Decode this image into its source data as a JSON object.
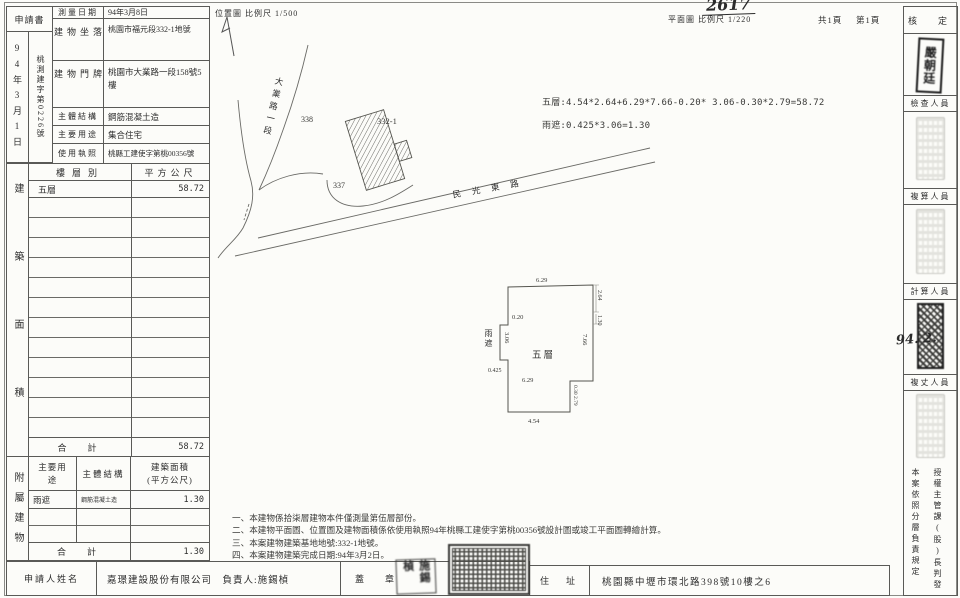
{
  "header": {
    "doc_no_handwritten": "2617",
    "site_map_label": "位置圖  比例尺 1/500",
    "plan_label": "平面圖  比例尺 1/220",
    "pages_total": "共1頁",
    "page_current": "第1頁"
  },
  "receipt": {
    "doc_label": "申請書",
    "date": "94年3月1日",
    "file_no": "桃測建字第0226號"
  },
  "building": {
    "survey_date_label": "測量日期",
    "survey_date": "94年3月8日",
    "site_label": "建物坐落",
    "site_value": "桃園市福元段332-1地號",
    "door_label": "建物門牌",
    "door_value": "桃園市大業路一段158號5樓",
    "structure_label": "主體結構",
    "structure_value": "鋼筋混凝土造",
    "use_label": "主要用途",
    "use_value": "集合住宅",
    "license_label": "使用執照",
    "license_value": "桃縣工建使字第桃00356號"
  },
  "floor_area": {
    "side_label": "建築面積",
    "col_floor": "樓層別",
    "col_sqm": "平方公尺",
    "floor_1": "五層",
    "area_1": "58.72",
    "total_label": "合　計",
    "total": "58.72"
  },
  "annex": {
    "side_label": "附屬建物",
    "col_use": "主要用途",
    "col_structure": "主體結構",
    "col_area_1": "建築面積",
    "col_area_2": "(平方公尺)",
    "use_1": "雨遮",
    "structure_1": "鋼筋混凝土造",
    "area_1": "1.30",
    "total_label": "合　計",
    "total": "1.30"
  },
  "applicant": {
    "name_label": "申請人姓名",
    "name_value": "嘉璟建設股份有限公司　負責人:施錫楨",
    "seal_label": "蓋　章",
    "person_seal": "施錫楨",
    "addr_label": "住　址",
    "addr_value": "桃園縣中壢市環北路398號10樓之6"
  },
  "site_plan": {
    "road_main": "大業路一段",
    "road_east": "民光東路",
    "parcel_338": "338",
    "parcel_332_1": "332-1",
    "parcel_337": "337"
  },
  "formula": {
    "line_floor": "五層:4.54*2.64+6.29*7.66-0.20* 3.06-0.30*2.79=58.72",
    "line_canopy": "雨遮:0.425*3.06=1.30"
  },
  "floor_plan": {
    "room_label": "五層",
    "canopy_label": "雨遮",
    "dim_top": "6.29",
    "dim_bottom": "4.54",
    "dim_right": "7.66",
    "dim_right_top": "2.64",
    "dim_right_top2": "1.30",
    "dim_left": "3.06",
    "dim_left_small": "0.20",
    "dim_canopy": "0.425",
    "dim_notch_w": "0.30",
    "dim_notch_h": "2.79",
    "dim_inner": "6.29"
  },
  "notes": {
    "n1": "一、本建物係拾柒層建物本件僅測量第伍層部份。",
    "n2": "二、本建物平面圖、位置圖及建物面積係依使用執照94年桃縣工建使字第桃00356號設計圖或竣工平面圖轉繪計算。",
    "n3": "三、本案建物建築基地地號:332-1地號。",
    "n4": "四、本案建物建築完成日期:94年3月2日。"
  },
  "approval": {
    "approve_label": "核　定",
    "approver_stamp": "嚴朝廷",
    "check_label": "檢查人員",
    "recalc_label": "複算人員",
    "calc_label": "計算人員",
    "resurvey_label": "複丈人員",
    "handwritten": "94. 2.",
    "delegation_left": "本案依照分層負責規定",
    "delegation_right": "授權主管課(股)長判發"
  }
}
